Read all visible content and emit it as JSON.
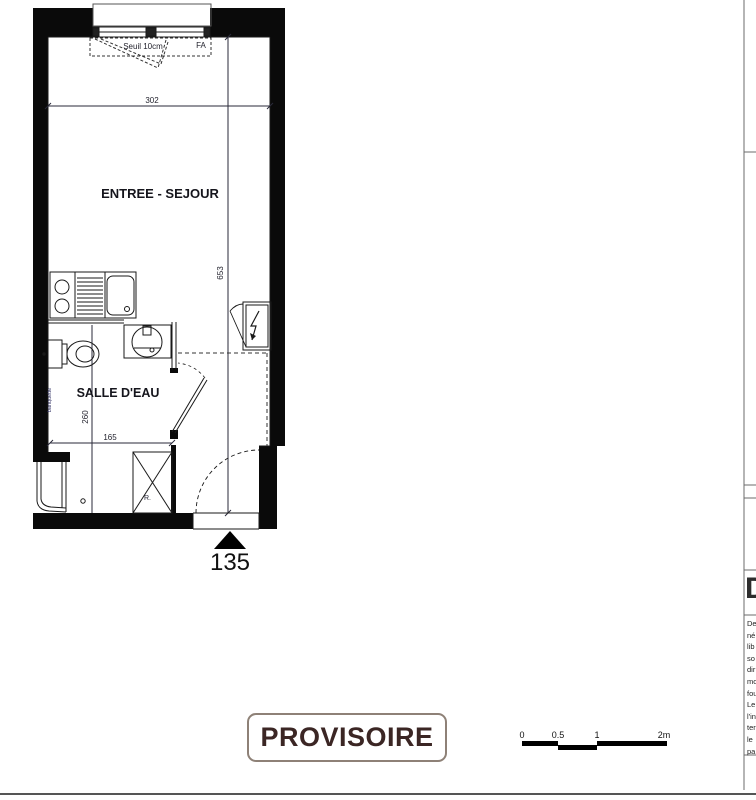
{
  "colors": {
    "wall_fill": "#0a0a0a",
    "linework": "#1a1a1a",
    "dimension_text": "#23232e",
    "stamp_text": "#3b2624",
    "stamp_border": "#8e8177"
  },
  "plan": {
    "unit_number": "135",
    "rooms": [
      {
        "name": "ENTREE - SEJOUR"
      },
      {
        "name": "SALLE D'EAU"
      }
    ],
    "window": {
      "type_label": "FA",
      "threshold_label": "Seuil 10cm"
    },
    "dimensions": {
      "living_width_cm": "302",
      "living_depth_cm": "653",
      "bath_depth_cm": "260",
      "bath_width_cm": "165"
    },
    "fixtures": {
      "storage_label": "R.",
      "bench_label": "banquette"
    }
  },
  "stamp": {
    "label": "PROVISOIRE"
  },
  "scale_bar": {
    "ticks": [
      "0",
      "0.5",
      "1",
      "2m"
    ]
  },
  "title_block": {
    "logo_letter": "D",
    "note_lines": [
      "De",
      "né",
      "lib",
      "so",
      "dir",
      "mo",
      "fou",
      "Le",
      "l'in",
      "ter",
      "le",
      "pa"
    ]
  }
}
